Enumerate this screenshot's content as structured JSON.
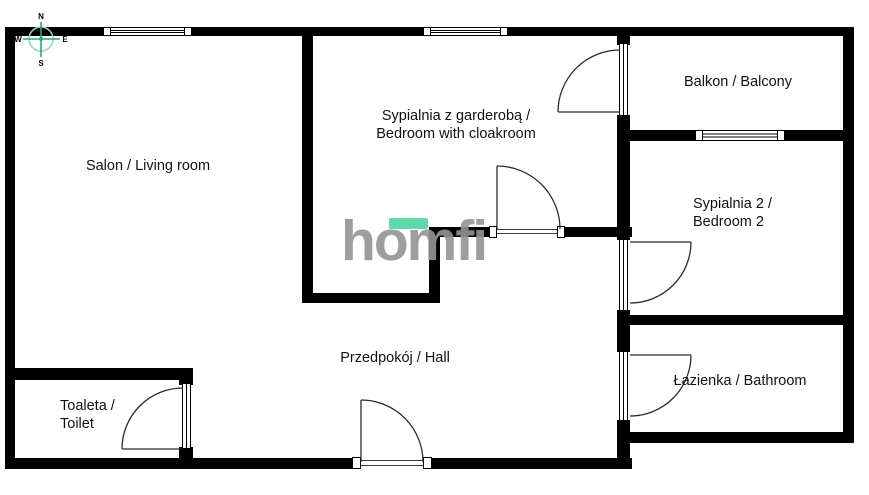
{
  "watermark": {
    "text": "homfi",
    "accent_color": "#5ed9a7",
    "text_color": "#949494"
  },
  "compass": {
    "n": "N",
    "e": "E",
    "s": "S",
    "w": "W"
  },
  "rooms": {
    "salon": {
      "label": "Salon / Living room"
    },
    "bedroom1": {
      "line1": "Sypialnia z garderobą /",
      "line2": "Bedroom with cloakroom"
    },
    "balcony": {
      "label": "Balkon / Balcony"
    },
    "bedroom2": {
      "line1": "Sypialnia 2 /",
      "line2": "Bedroom 2"
    },
    "hall": {
      "label": "Przedpokój / Hall"
    },
    "toilet": {
      "line1": "Toaleta /",
      "line2": "Toilet"
    },
    "bathroom": {
      "label": "Łazienka / Bathroom"
    }
  },
  "colors": {
    "wall": "#000000",
    "door_line": "#2b2b2b",
    "compass_cross": "#2ba57b",
    "compass_circle": "#95d7bc",
    "text": "#111111"
  }
}
